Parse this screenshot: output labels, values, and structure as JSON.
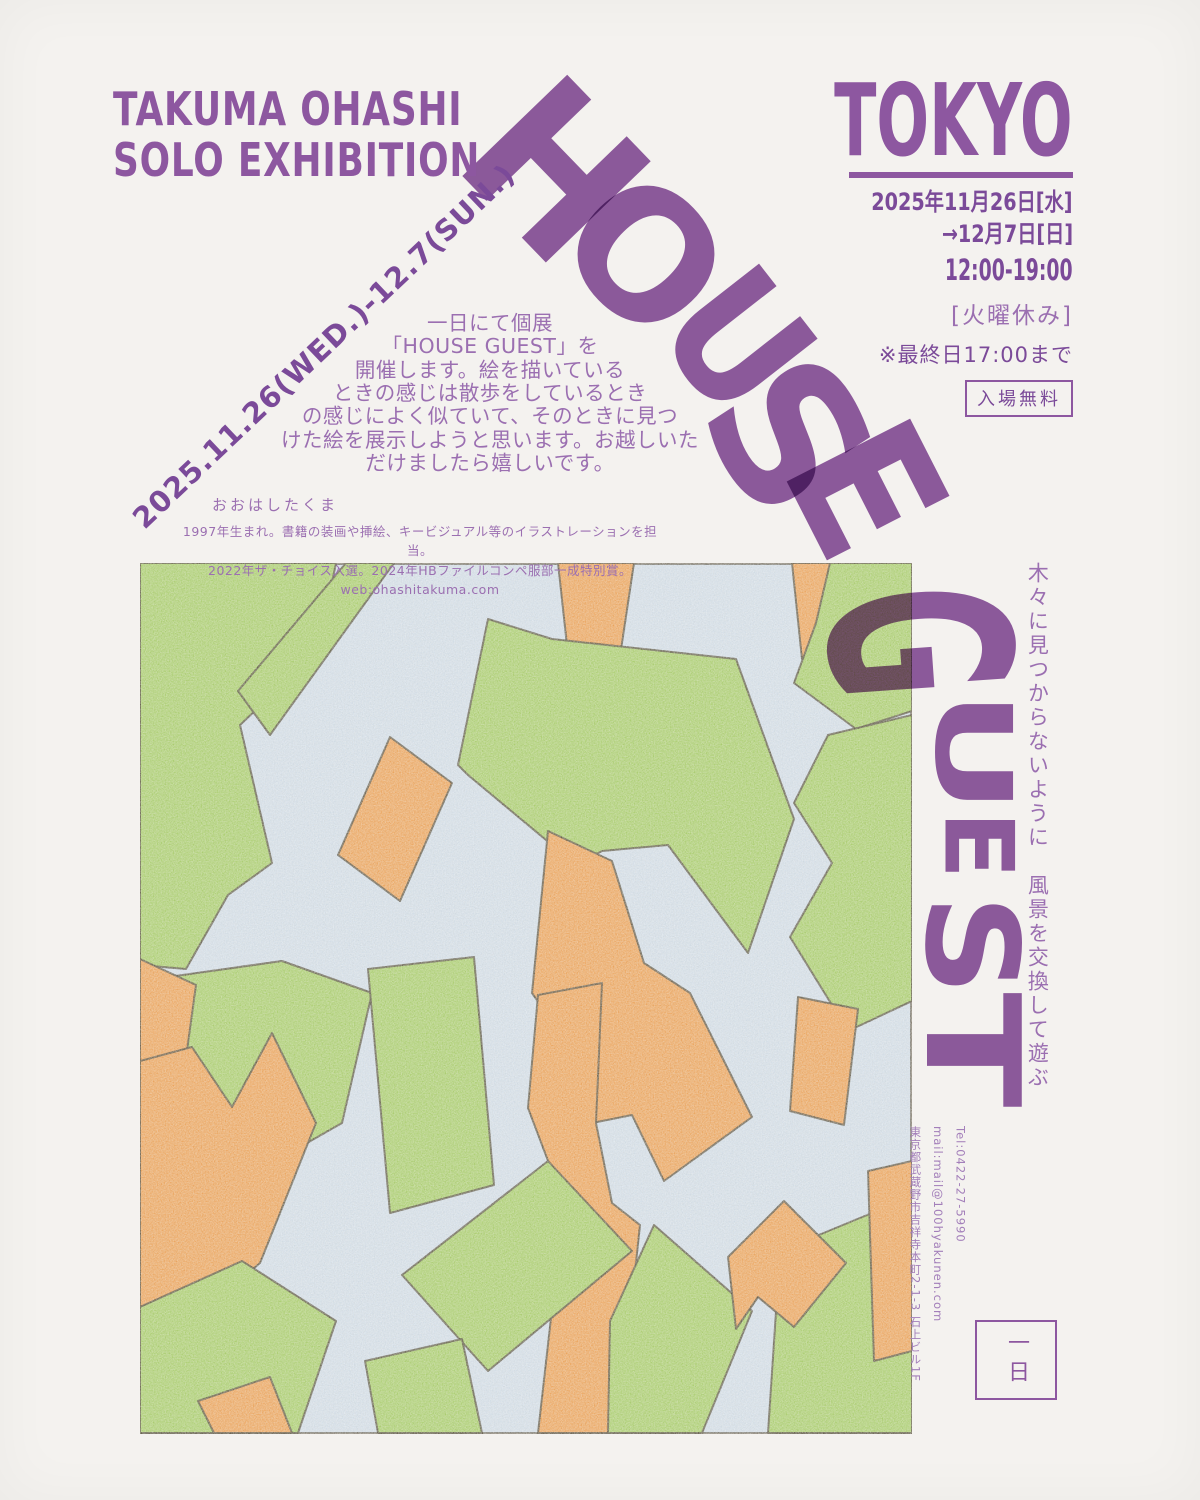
{
  "palette": {
    "purple": "#8d57a0",
    "purple_dark": "#7b4a99",
    "purple_light": "#9b6fb1",
    "purple_pale": "#a37fba",
    "paper": "#f4f2ef",
    "art_blue": "#d3e0ed",
    "art_green": "#a6cf66",
    "art_orange": "#f0a152",
    "art_outline": "#4b4433"
  },
  "header": {
    "exhibition_line1": "TAKUMA OHASHI",
    "exhibition_line2": "SOLO EXHIBITION"
  },
  "venue_city": "TOKYO",
  "schedule": {
    "date_line1": "2025年11月26日[水]",
    "date_line2": "→12月7日[日]",
    "hours": "12:00-19:00",
    "closed": "[火曜休み]",
    "last_day_note": "※最終日17:00まで",
    "admission": "入場無料"
  },
  "diagonal_date": "2025.11.26(WED.)-12.7(SUN.)",
  "intro_text": "一日にて個展\n「HOUSE GUEST」を\n開催します。絵を描いている\nときの感じは散歩をしているとき\nの感じによく似ていて、そのときに見つ\nけた絵を展示しようと思います。お越しいた\nだけましたら嬉しいです。",
  "artist": {
    "name": "おおはしたくま",
    "bio_line1": "1997年生まれ。書籍の装画や挿絵、キービジュアル等のイラストレーションを担当。",
    "bio_line2": "2022年ザ・チョイス入選。2024年HBファイルコンペ服部一成特別賞。web:ohashitakuma.com"
  },
  "title_word": "HOUSE GUEST",
  "title_letters": [
    {
      "ch": "H",
      "x": 553,
      "y": 172,
      "rot": 46,
      "size": 200,
      "sx": 0.92,
      "sy": 1
    },
    {
      "ch": "O",
      "x": 643,
      "y": 257,
      "rot": 46,
      "size": 175,
      "sx": 1,
      "sy": 1
    },
    {
      "ch": "U",
      "x": 736,
      "y": 342,
      "rot": 52,
      "size": 172,
      "sx": 0.88,
      "sy": 1
    },
    {
      "ch": "S",
      "x": 786,
      "y": 437,
      "rot": 57,
      "size": 192,
      "sx": 1,
      "sy": 1
    },
    {
      "ch": "E",
      "x": 864,
      "y": 490,
      "rot": 63,
      "size": 190,
      "sx": 0.9,
      "sy": 1
    },
    {
      "ch": "G",
      "x": 916,
      "y": 642,
      "rot": 86,
      "size": 250,
      "sx": 0.55,
      "sy": 1
    },
    {
      "ch": "U",
      "x": 972,
      "y": 752,
      "rot": 90,
      "size": 105,
      "sx": 1.45,
      "sy": 1
    },
    {
      "ch": "E",
      "x": 977,
      "y": 845,
      "rot": 90,
      "size": 95,
      "sx": 1.05,
      "sy": 1
    },
    {
      "ch": "S",
      "x": 970,
      "y": 945,
      "rot": 90,
      "size": 128,
      "sx": 1.1,
      "sy": 1
    },
    {
      "ch": "T",
      "x": 972,
      "y": 1050,
      "rot": 90,
      "size": 130,
      "sx": 1.3,
      "sy": 1
    }
  ],
  "tagline_vertical": "木々に見つからないように　風景を交換して遊ぶ",
  "contact": {
    "tel": "Tel:0422-27-5990",
    "mail": "mail:mail@100hyakunen.com",
    "address": "東京都武蔵野市吉祥寺本町2-1-3 石上ビル1F"
  },
  "gallery_name": "一日",
  "artwork_alt": "abstract collage of green and orange paper-like strips on light blue"
}
